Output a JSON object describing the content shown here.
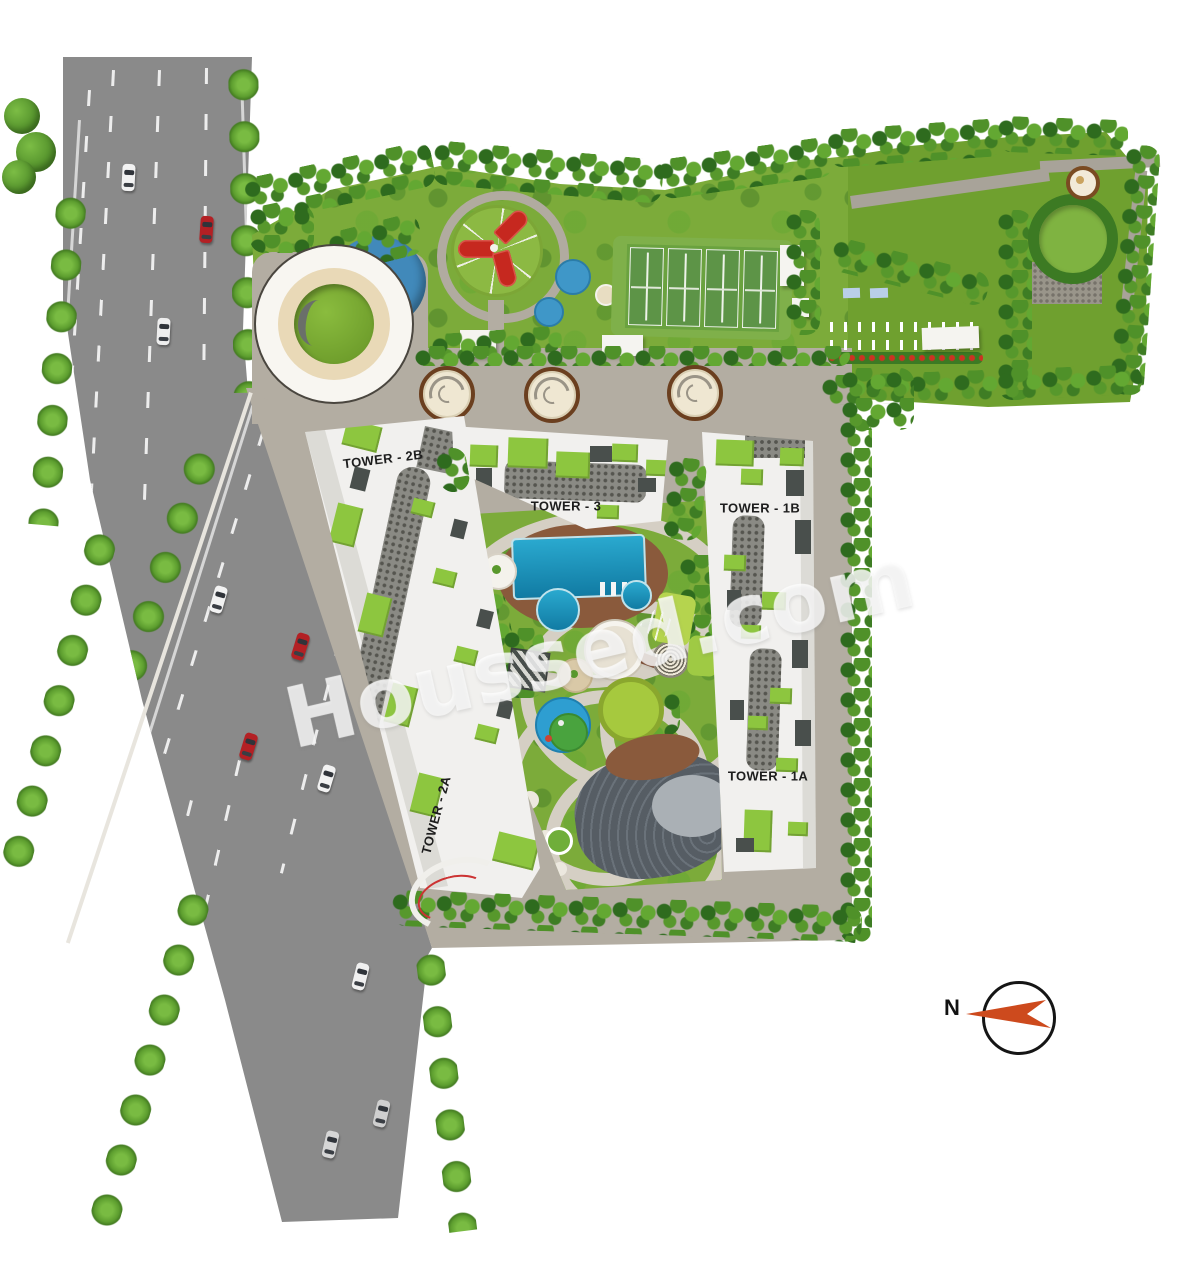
{
  "watermark": {
    "text": "Houssed.com"
  },
  "compass": {
    "north_label": "N"
  },
  "towers": [
    {
      "label": "TOWER - 2B"
    },
    {
      "label": "TOWER - 3"
    },
    {
      "label": "TOWER - 1B"
    },
    {
      "label": "TOWER - 2A"
    },
    {
      "label": "TOWER - 1A"
    }
  ],
  "features": [
    "entrance-plaza",
    "water-cascade",
    "kids-play-courts",
    "splash-pads",
    "tennis-courts",
    "clubhouse",
    "party-lawn",
    "seating-rows",
    "flower-beds",
    "gravel-court",
    "tree-ring-lawn",
    "driveway-mandalas",
    "swimming-pool",
    "kids-pool",
    "pool-deck",
    "fountain-plaza",
    "maze-garden",
    "central-lawn",
    "splash-play-zone",
    "amphitheatre",
    "main-road",
    "median-trees",
    "avenue-trees",
    "perimeter-hedge"
  ],
  "colors": {
    "roof_accent_green": "#8dc63f",
    "pool_water_blue": "#1f96c0",
    "sports_court_red": "#c6281f",
    "lawn_green": "#79aa35",
    "dense_tree_green": "#3e7d28",
    "road_asphalt_gray": "#8a8a8a",
    "site_paving_beige": "#b3ada2",
    "building_white": "#f1f0ee",
    "compass_arrow_orange": "#cd4a1d"
  }
}
